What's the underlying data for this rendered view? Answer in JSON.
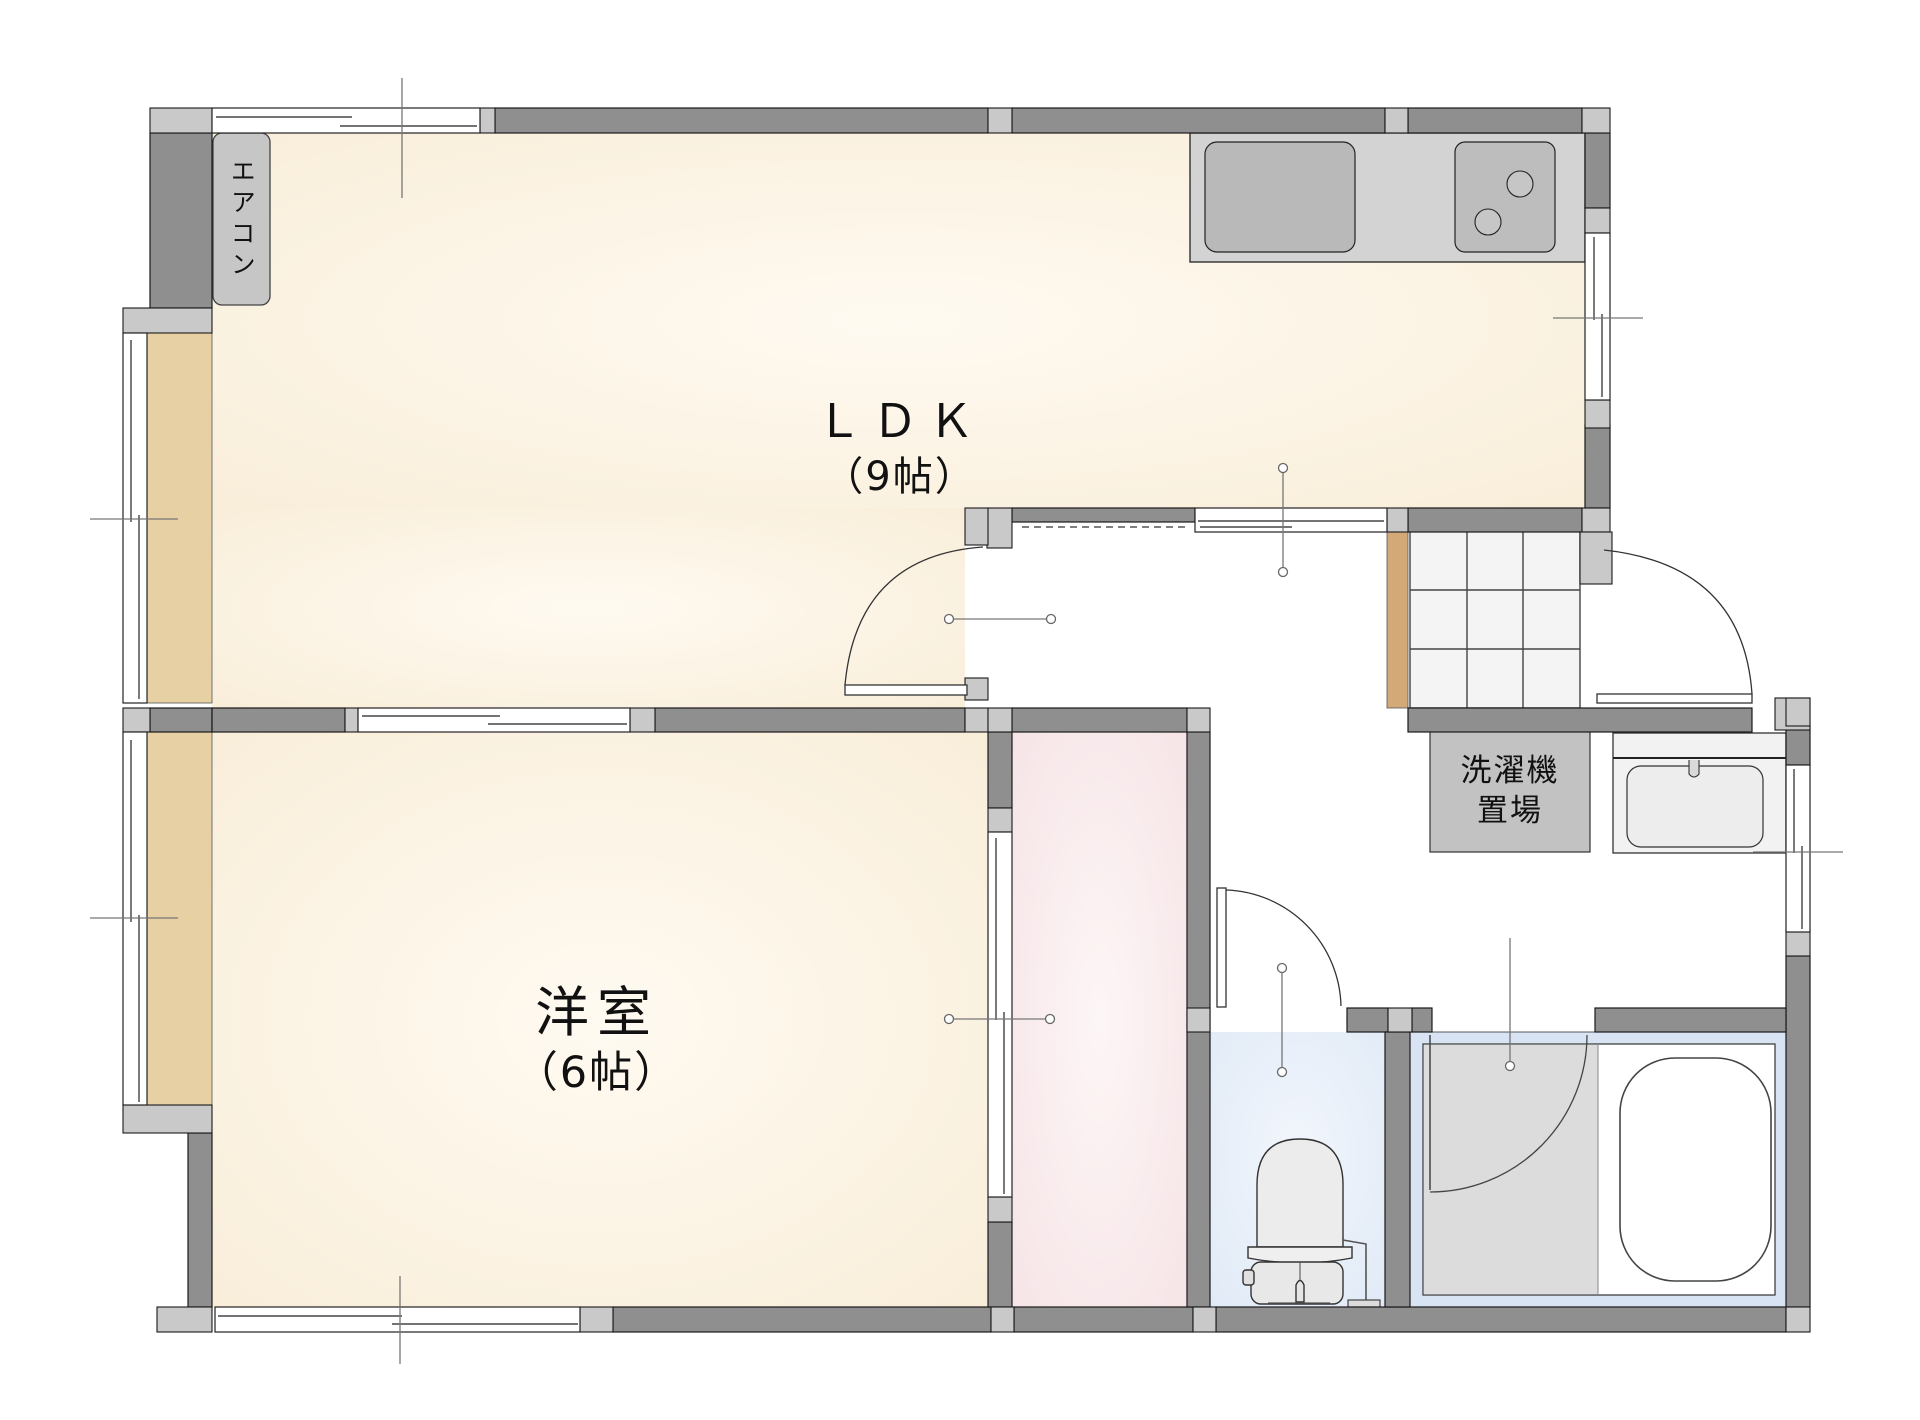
{
  "plan": {
    "type": "japanese-apartment-floor-plan",
    "rooms": {
      "ldk": {
        "name": "ＬＤＫ",
        "size": "（9帖）"
      },
      "western_room": {
        "name": "洋室",
        "size": "（6帖）"
      },
      "laundry_area": {
        "line1": "洗濯機",
        "line2": "置場"
      },
      "aircon": {
        "label": "エアコン"
      }
    },
    "fixtures": [
      "kitchen-sink",
      "stove-2-burner",
      "shoe-cabinet-grid",
      "washing-machine-area",
      "washbasin",
      "toilet",
      "bathtub"
    ],
    "colors": {
      "wall_dark": "#8f8f8f",
      "wall_post_light": "#c9c9c9",
      "floor_cream_edge": "#f8edd8",
      "floor_cream_center": "#fffaf1",
      "floor_pink": "#f6e3e6",
      "floor_toilet_blue": "#e3ebf7",
      "bath_frame_blue": "#d8e3f3",
      "bath_wet_area_gray": "#dcdcdc",
      "tan_sill": "#e7d0a4",
      "entry_tan": "#d2a977",
      "counter_gray": "#d3d3d3",
      "appliance_gray": "#b9b9b9",
      "measure_line": "#777777",
      "outline": "#1a1a1a"
    }
  }
}
